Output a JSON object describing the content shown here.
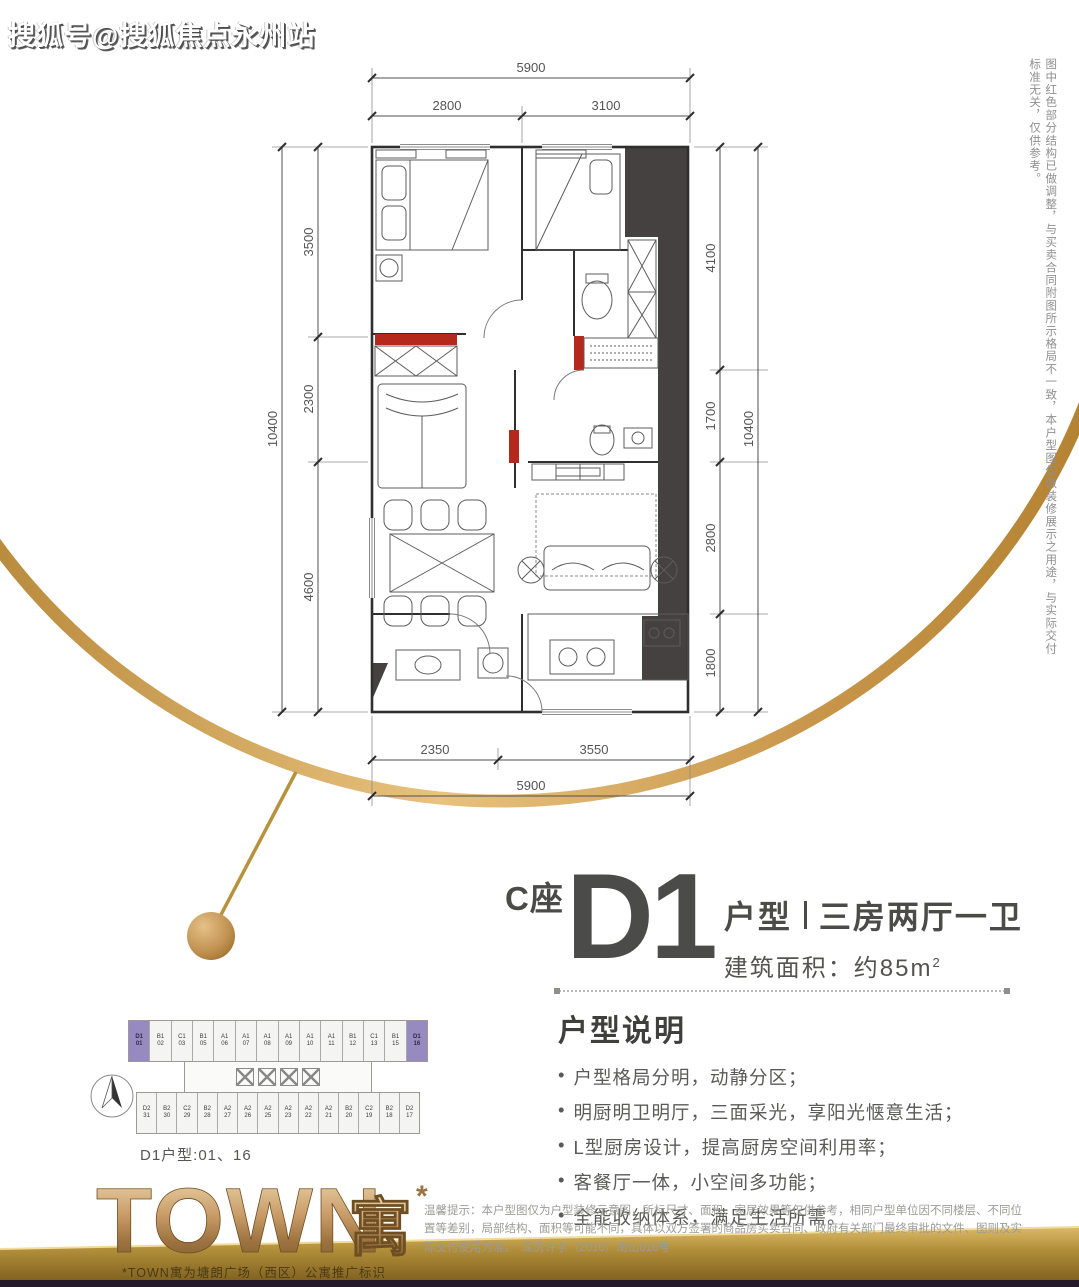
{
  "watermark": "搜狐号@搜狐焦点永州站",
  "side_note": "图中红色部分结构已做调整，与买卖合同附图所示格局不一致，本户型图仅做装修展示之用途，与实际交付标准无关，仅供参考。",
  "floor_plan": {
    "dims_top": {
      "overall": "5900",
      "segments": [
        "2800",
        "3100"
      ]
    },
    "dims_left": {
      "overall": "10400",
      "segments": [
        "3500",
        "2300",
        "4600"
      ]
    },
    "dims_right": {
      "overall": "10400",
      "segments": [
        "4100",
        "1700",
        "2800",
        "1800"
      ]
    },
    "dims_bottom": {
      "overall": "5900",
      "segments": [
        "2350",
        "3550"
      ]
    }
  },
  "title": {
    "block": "C座",
    "unit": "D1",
    "type_label": "户型",
    "layout": "三房两厅一卫",
    "area_label": "建筑面积：约85m",
    "area_sup": "2"
  },
  "description": {
    "heading": "户型说明",
    "bullets": [
      "户型格局分明，动静分区；",
      "明厨明卫明厅，三面采光，享阳光惬意生活；",
      "L型厨房设计，提高厨房空间利用率；",
      "客餐厅一体，小空间多功能；",
      "全能收纳体系，满足生活所需。"
    ]
  },
  "floor_plate": {
    "caption": "D1户型:01、16",
    "top_row": [
      {
        "t": "D1",
        "n": "01",
        "hl": true
      },
      {
        "t": "B1",
        "n": "02"
      },
      {
        "t": "C1",
        "n": "03"
      },
      {
        "t": "B1",
        "n": "05"
      },
      {
        "t": "A1",
        "n": "06"
      },
      {
        "t": "A1",
        "n": "07"
      },
      {
        "t": "A1",
        "n": "08"
      },
      {
        "t": "A1",
        "n": "09"
      },
      {
        "t": "A1",
        "n": "10"
      },
      {
        "t": "A1",
        "n": "11"
      },
      {
        "t": "B1",
        "n": "12"
      },
      {
        "t": "C1",
        "n": "13"
      },
      {
        "t": "B1",
        "n": "15"
      },
      {
        "t": "D1",
        "n": "16",
        "hl": true
      }
    ],
    "bottom_row": [
      {
        "t": "D2",
        "n": "31"
      },
      {
        "t": "B2",
        "n": "30"
      },
      {
        "t": "C2",
        "n": "29"
      },
      {
        "t": "B2",
        "n": "28"
      },
      {
        "t": "A2",
        "n": "27"
      },
      {
        "t": "A2",
        "n": "26"
      },
      {
        "t": "A2",
        "n": "25"
      },
      {
        "t": "A2",
        "n": "23"
      },
      {
        "t": "A2",
        "n": "22"
      },
      {
        "t": "A2",
        "n": "21"
      },
      {
        "t": "B2",
        "n": "20"
      },
      {
        "t": "C2",
        "n": "19"
      },
      {
        "t": "B2",
        "n": "18"
      },
      {
        "t": "D2",
        "n": "17"
      }
    ]
  },
  "logo": {
    "text": "TOWN",
    "suffix": "寓",
    "asterisk": "*",
    "caption": "*TOWN寓为塘朗广场（西区）公寓推广标识"
  },
  "disclaimer": "温馨提示：本户型图仅为户型装修示意图，所标尺寸、面积、家居效果等仅供参考，相同户型单位因不同楼层、不同位置等差别，局部结构、面积等可能不同，具体以双方签署的商品房买卖合同、政府有关部门最终审批的文件、图则及实际交付使用为准。　深房许字（2016）南山016号",
  "colors": {
    "accent_red": "#b5281c",
    "gold": "#c89b4a",
    "dark_wall": "#454140",
    "purple_unit": "#968ac1"
  }
}
